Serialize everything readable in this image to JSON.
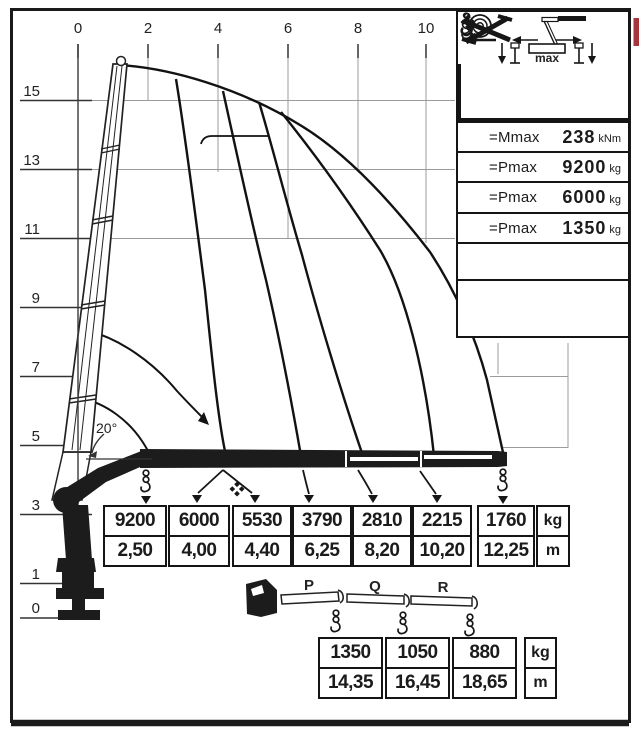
{
  "axes": {
    "top_ticks": [
      "0",
      "2",
      "4",
      "6",
      "8",
      "10"
    ],
    "left_ticks": [
      "15",
      "13",
      "11",
      "9",
      "7",
      "5",
      "3",
      "1",
      "0"
    ]
  },
  "boom_angle_label": "20°",
  "legend": {
    "rows": [
      {
        "icon": "mmax-symbol",
        "label": "=Mmax",
        "value": "238",
        "unit": "kNm"
      },
      {
        "icon": "hook-pulley",
        "label": "=Pmax",
        "value": "9200",
        "unit": "kg"
      },
      {
        "icon": "hook",
        "label": "=Pmax",
        "value": "6000",
        "unit": "kg"
      },
      {
        "icon": "hook-small",
        "label": "=Pmax",
        "value": "1350",
        "unit": "kg"
      }
    ],
    "outrigger_max_label": "max"
  },
  "capacity_table": {
    "columns": [
      {
        "load": "9200",
        "reach": "2,50"
      },
      {
        "load": "6000",
        "reach": "4,00"
      },
      {
        "load": "5530",
        "reach": "4,40"
      },
      {
        "load": "3790",
        "reach": "6,25"
      },
      {
        "load": "2810",
        "reach": "8,20"
      },
      {
        "load": "2215",
        "reach": "10,20"
      },
      {
        "load": "1760",
        "reach": "12,25"
      }
    ],
    "load_unit": "kg",
    "reach_unit": "m"
  },
  "extension_table": {
    "section_labels": [
      "P",
      "Q",
      "R"
    ],
    "columns": [
      {
        "load": "1350",
        "reach": "14,35"
      },
      {
        "load": "1050",
        "reach": "16,45"
      },
      {
        "load": "880",
        "reach": "18,65"
      }
    ],
    "load_unit": "kg",
    "reach_unit": "m"
  },
  "chart_data": {
    "type": "line",
    "title": "Crane lifting capacity envelope",
    "xlabel": "outreach (m)",
    "ylabel": "height (m)",
    "x_range": [
      0,
      12.5
    ],
    "y_range": [
      0,
      16.5
    ],
    "grid": true,
    "series": [
      {
        "name": "load capacity at outreach",
        "x_reach_m": [
          2.5,
          4.0,
          4.4,
          6.25,
          8.2,
          10.2,
          12.25,
          14.35,
          16.45,
          18.65
        ],
        "y_load_kg": [
          9200,
          6000,
          5530,
          3790,
          2810,
          2215,
          1760,
          1350,
          1050,
          880
        ]
      }
    ],
    "constants": {
      "Mmax_kNm": 238,
      "Pmax_hoist_kg": 9200,
      "Pmax_hook_kg": 6000,
      "Pmax_extension_kg": 1350
    },
    "boom_min_angle_deg": 20
  },
  "colors": {
    "ink": "#1b1b1b",
    "grid": "#9b9b9b",
    "accent_red": "#a8343c",
    "background": "#ffffff"
  }
}
